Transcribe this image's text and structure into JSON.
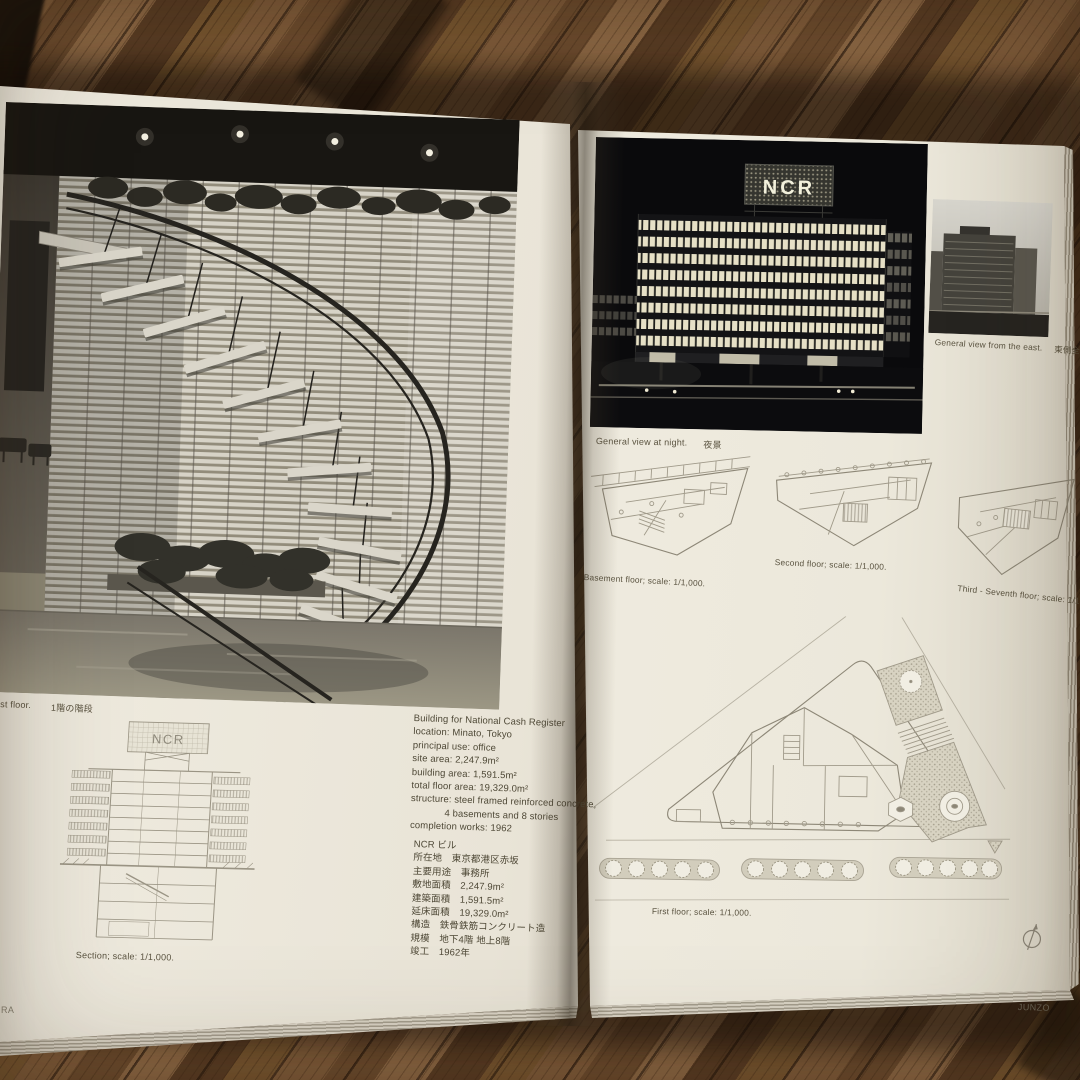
{
  "palette": {
    "paper": "#f0ece0",
    "wood_mid": "#7d5a39",
    "wood_dark": "#573b23",
    "photo_black": "#0a0a0c",
    "ink": "#4e4836"
  },
  "sign_text": "NCR",
  "left_page": {
    "photo_caption_en": "irst floor.",
    "photo_caption_jp": "1階の階段",
    "section_caption": "Section; scale: 1/1,000.",
    "specs_en": {
      "title": "Building for National Cash Register",
      "lines": [
        "location: Minato, Tokyo",
        "principal use: office",
        "site area: 2,247.9m²",
        "building area: 1,591.5m²",
        "total floor area: 19,329.0m²",
        "structure: steel framed reinforced concrete,",
        "4 basements and 8 stories",
        "completion works: 1962"
      ]
    },
    "specs_jp": {
      "title": "NCR ビル",
      "lines": [
        "所在地　東京都港区赤坂",
        "主要用途　事務所",
        "敷地面積　2,247.9m²",
        "建築面積　1,591.5m²",
        "延床面積　19,329.0m²",
        "構造　鉄骨鉄筋コンクリート造",
        "規模　地下4階 地上8階",
        "竣工　1962年"
      ]
    },
    "footer": "RA"
  },
  "right_page": {
    "night_caption_en": "General view at night.",
    "night_caption_jp": "夜景",
    "east_caption_en": "General view from the east.",
    "east_caption_jp": "東側全景",
    "plans": {
      "basement": "Basement floor; scale: 1/1,000.",
      "second": "Second floor; scale: 1/1,000.",
      "third": "Third - Seventh floor; scale: 1/1,000.",
      "first": "First floor; scale: 1/1,000."
    },
    "footer": "JUNZO"
  }
}
